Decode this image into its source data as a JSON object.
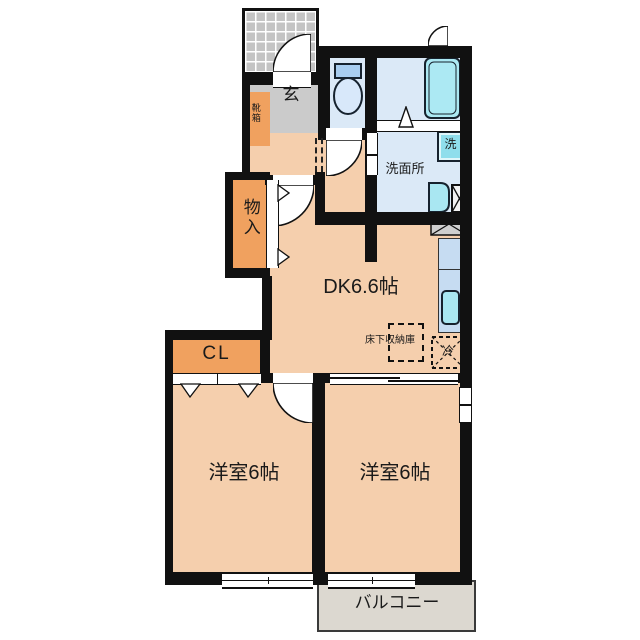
{
  "plan": {
    "labels": {
      "entrance": "玄",
      "shoe_cabinet": "靴箱",
      "storage": "物入",
      "closet": "CL",
      "dining_kitchen": "DK6.6帖",
      "underfloor_storage": "床下収納庫",
      "refrigerator": "冷",
      "washing_machine": "洗",
      "washroom": "洗面所",
      "bedroom_left": "洋室6帖",
      "bedroom_right": "洋室6帖",
      "balcony": "バルコニー"
    },
    "colors": {
      "wall": "#111111",
      "floor_peach": "#f5cfad",
      "cabinet_orange": "#f0a15f",
      "entrance_gray": "#cbcbcb",
      "wet_area_blue": "#dbe9f7",
      "fixture_cyan": "#a9e7f2",
      "counter_blue": "#c6dcf2",
      "balcony_gray": "#dcd8d0",
      "porch_tile_gray": "#c4c4c4"
    }
  }
}
